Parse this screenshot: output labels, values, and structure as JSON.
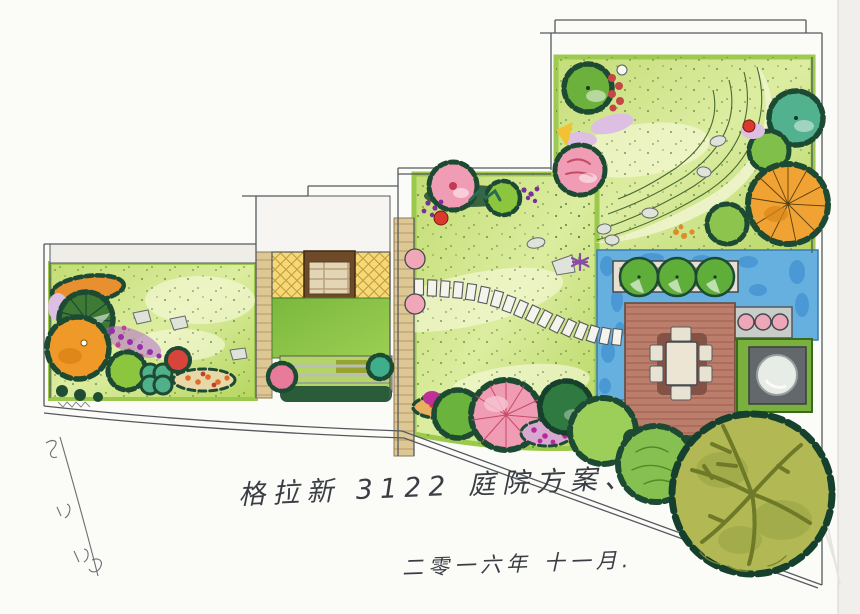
{
  "annotations": {
    "title": "格拉新 3122 庭院方案、",
    "date": "二零一六年 十一月."
  },
  "palette": {
    "paper": "#fbfbf8",
    "lawn_base": "#cde283",
    "lawn_bright": "#a9d15c",
    "lawn_light": "#edf4bc",
    "hedge_dark": "#1d4a33",
    "water_blue": "#66b0e0",
    "water_deep": "#4795d2",
    "deck_wood": "#bc7e6c",
    "deck_line": "#8a4a3c",
    "paving_yellow": "#f5d977",
    "paver_tan": "#ddc795",
    "brick_frame": "#6e4a28",
    "brick_fill": "#e2d6b6",
    "tree_green": "#6cb13c",
    "tree_apple": "#8cc63f",
    "tree_teal": "#52b18e",
    "tree_pink": "#f09cb4",
    "tree_orange": "#f0a233",
    "tree_olive": "#b2b954",
    "tree_darkgreen": "#2f7a40",
    "flower_purple": "#9a30a8",
    "flower_magenta": "#c23f98",
    "flower_red": "#d9392e",
    "stone_pink": "#f0a8b8",
    "stone_gray": "#dfe3da",
    "spa_gray": "#63686c",
    "outline": "#4a4e52"
  }
}
